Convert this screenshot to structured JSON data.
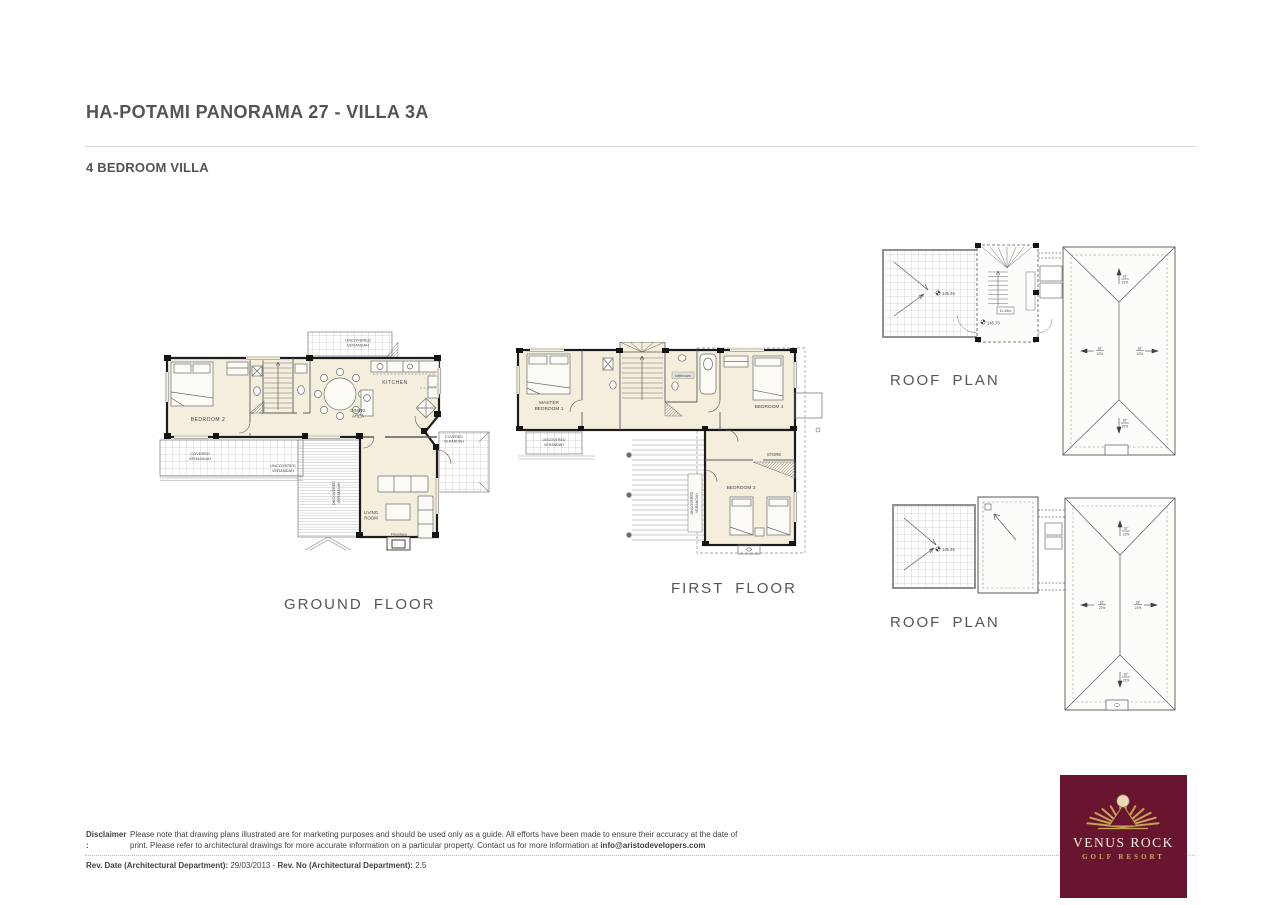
{
  "header": {
    "title": "HA-POTAMI PANORAMA 27 - VILLA 3A",
    "subtitle": "4 BEDROOM VILLA"
  },
  "words": {
    "uncovered": "UNCOVERED",
    "covered": "COVERED",
    "verandah": "VERANDAH"
  },
  "ground_floor": {
    "label": "GROUND FLOOR",
    "bedroom2": "BEDROOM 2",
    "kitchen": "KITCHEN",
    "dining_line1": "DINING",
    "dining_line2": "AREA",
    "living_line1": "LIVING",
    "living_line2": "ROOM",
    "fireplace": "Fireplace"
  },
  "first_floor": {
    "label": "FIRST FLOOR",
    "master_line1": "MASTER",
    "master_line2": "BEDROOM 1",
    "bathroom": "bathroom",
    "bedroom4": "BEDROOM 4",
    "store": "STORE",
    "bedroom3": "BEDROOM 3"
  },
  "roof_plans": {
    "label_upper": "ROOF PLAN",
    "label_lower": "ROOF PLAN",
    "level_top": "145.45",
    "level_mid": "145.70",
    "stair_dim": "11.44m",
    "level_lower": "145.45",
    "slope_angle": "16°",
    "slope_grade": "22%"
  },
  "footer": {
    "disclaimer_label": "Disclaimer :",
    "line1": "Please note that drawing plans illustrated are for marketing purposes and should be used only as a guide. All efforts have been made to ensure their accuracy at the date of print.",
    "line2": "Please refer to architectural drawings for more accurate information on a particular property. Contact us for more information at",
    "email": "info@aristodevelopers.com",
    "rev_date_label": "Rev. Date (Architectural Department):",
    "rev_date_value": "29/03/2013",
    "rev_dash": "-",
    "rev_no_label": "Rev. No (Architectural Department):",
    "rev_no_value": "2.5"
  },
  "logo": {
    "name_line": "VENUS ROCK",
    "tagline": "GOLF RESORT"
  },
  "colors": {
    "plan_fill": "#f4eedd",
    "wall": "#1c1c1c",
    "thin_line": "#6b6e71",
    "logo_maroon": "#6a1530",
    "logo_gold": "#c5a254",
    "title_text": "#535459"
  }
}
